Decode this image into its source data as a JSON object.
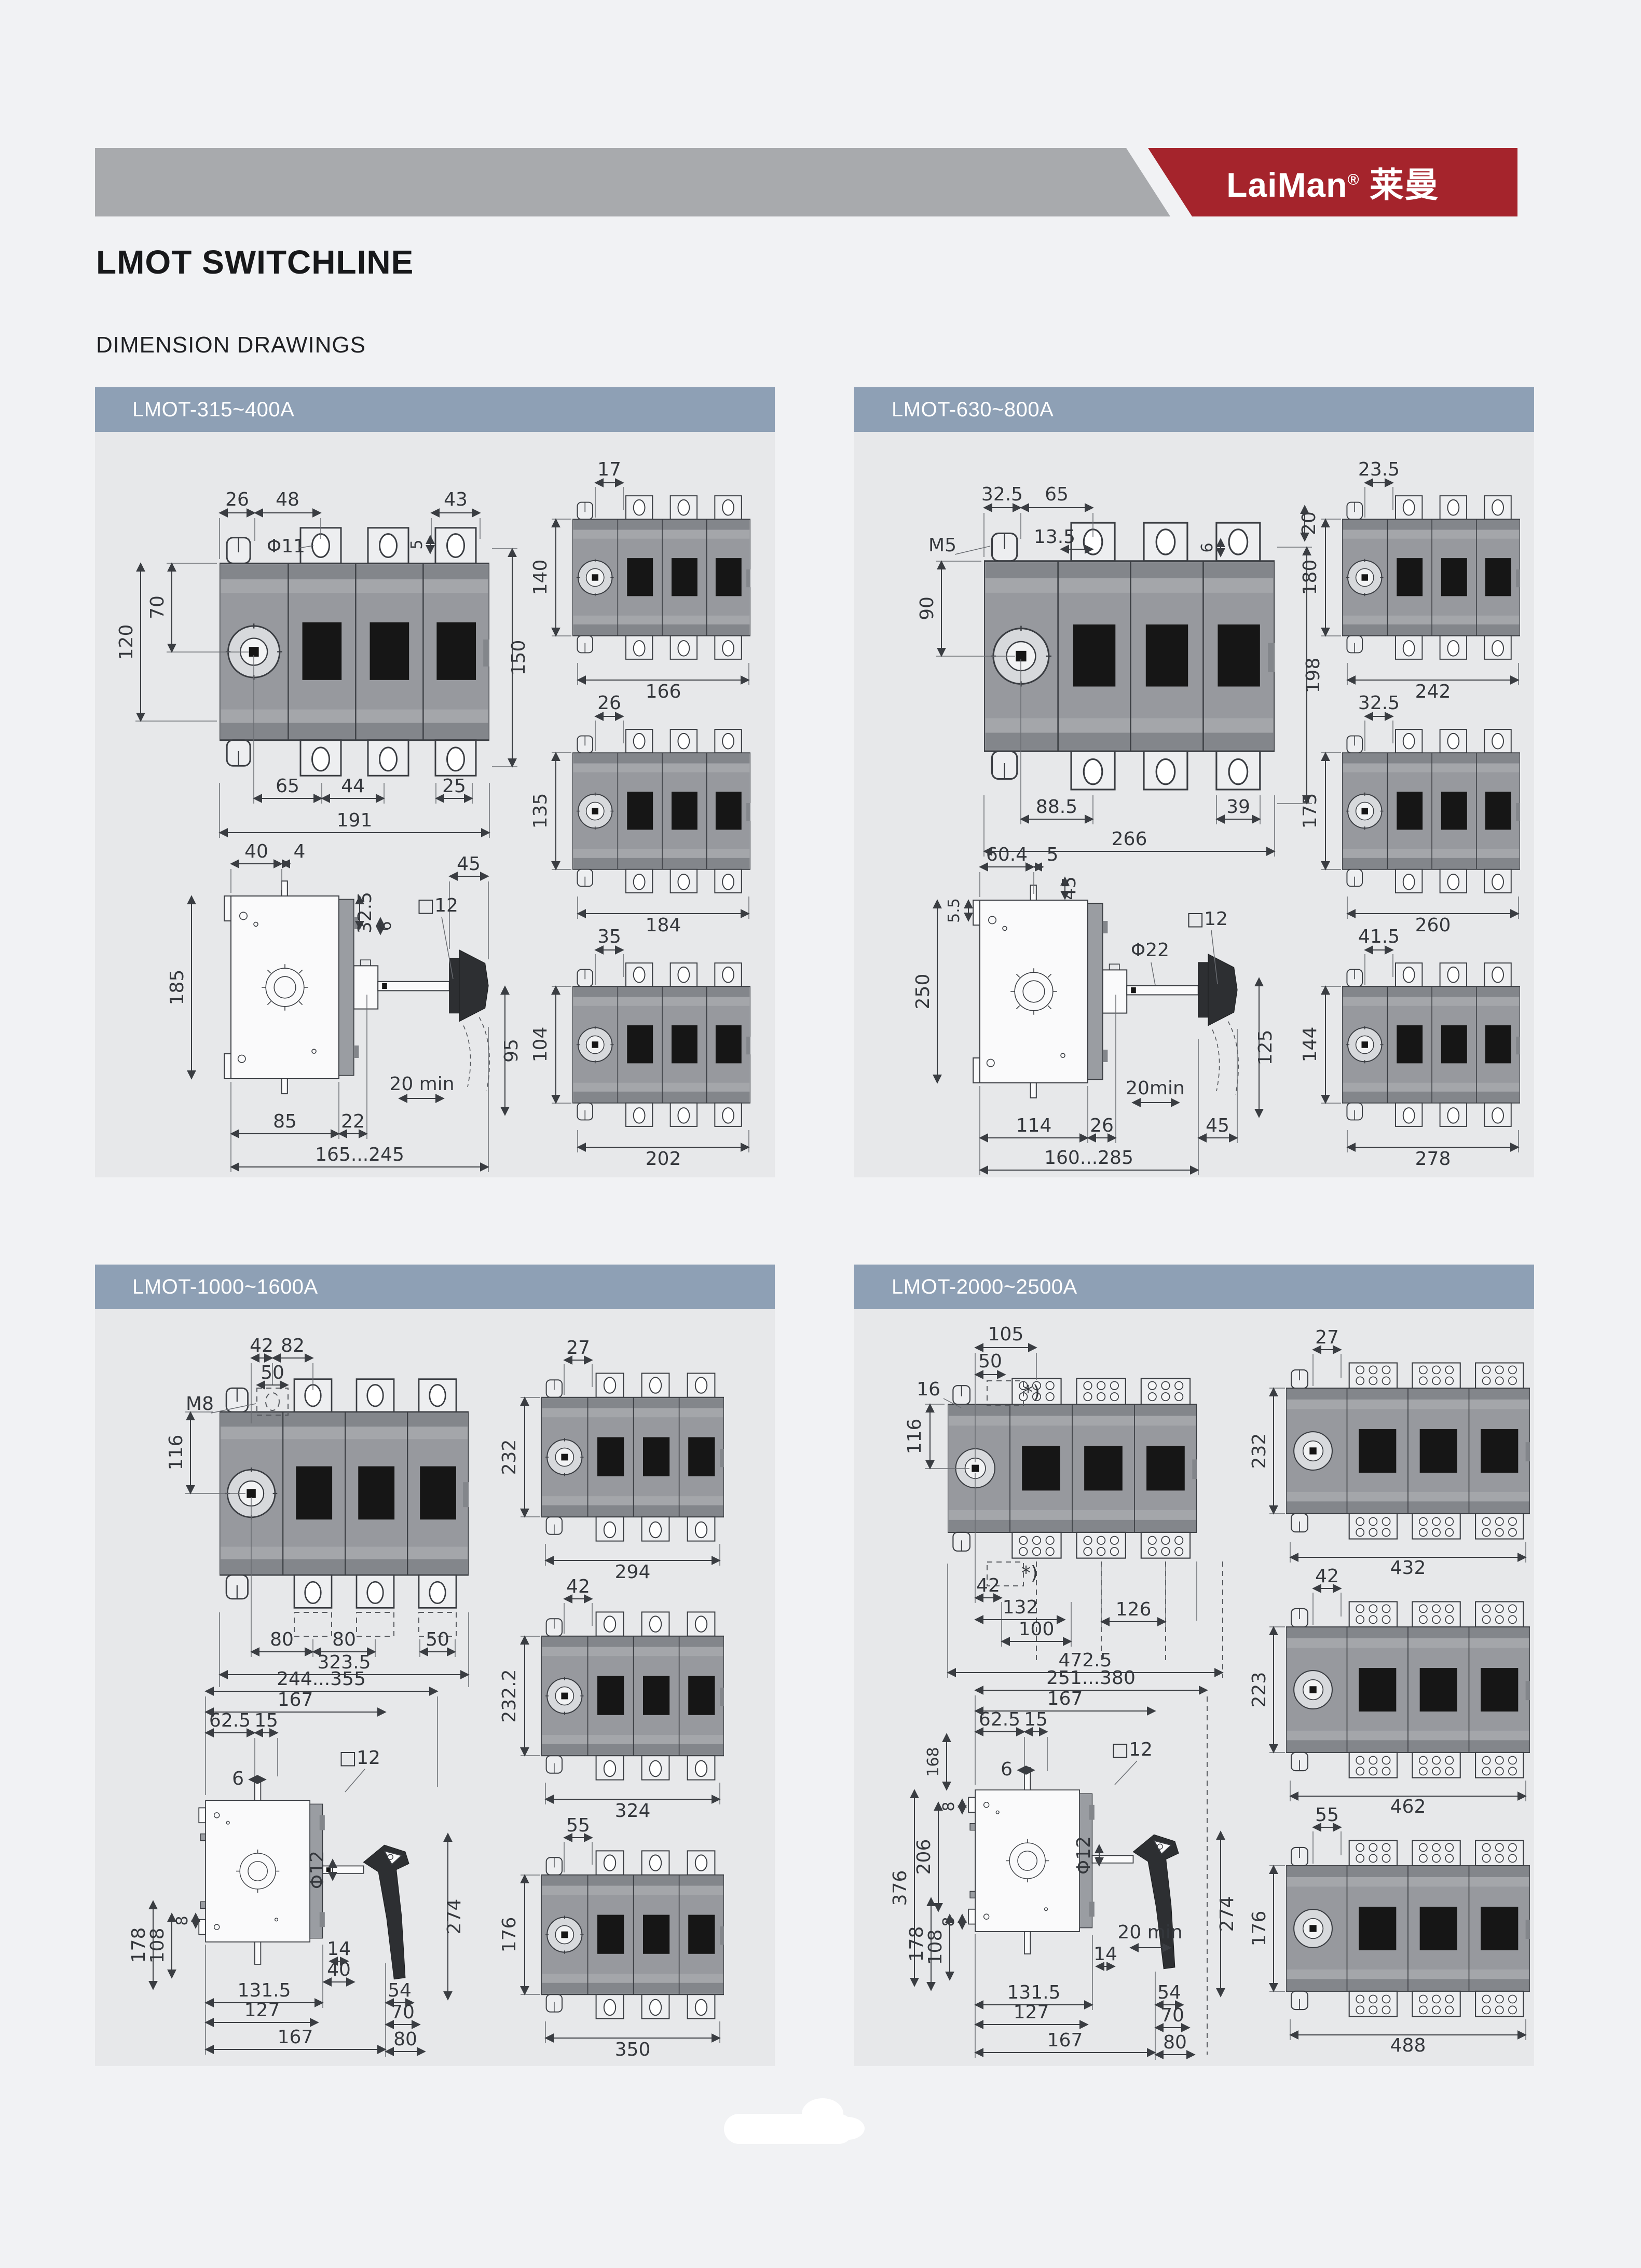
{
  "page": {
    "logo": {
      "text": "LaiMan",
      "reg": "®",
      "cn": "莱曼"
    },
    "title": "LMOT SWITCHLINE",
    "subtitle": "DIMENSION DRAWINGS",
    "colors": {
      "accent_red": "#a5242c",
      "top_bar_gray": "#a8aaad",
      "panel_header_blue": "#8ea0b5",
      "panel_bg": "#e7e8ea",
      "page_bg": "#f1f2f4"
    }
  },
  "panels": [
    {
      "title": "LMOT-315~400A",
      "front": [
        "26",
        "48",
        "43",
        "Φ11",
        "5",
        "70",
        "120",
        "150",
        "65",
        "44",
        "25",
        "191"
      ],
      "side": [
        "40",
        "4",
        "32.5",
        "6",
        "□12",
        "45",
        "185",
        "20 min",
        "95",
        "85",
        "22",
        "165...245"
      ],
      "rears": [
        [
          "17",
          "140",
          "166"
        ],
        [
          "26",
          "135",
          "184"
        ],
        [
          "35",
          "104",
          "202"
        ]
      ]
    },
    {
      "title": "LMOT-630~800A",
      "front": [
        "32.5",
        "65",
        "M5",
        "13.5",
        "6",
        "20",
        "90",
        "198",
        "88.5",
        "39",
        "266"
      ],
      "side": [
        "60.4",
        "5",
        "5.5",
        "45",
        "Φ22",
        "□12",
        "250",
        "20min",
        "114",
        "26",
        "45",
        "160...285",
        "125"
      ],
      "rears": [
        [
          "23.5",
          "180",
          "242"
        ],
        [
          "32.5",
          "175",
          "260"
        ],
        [
          "41.5",
          "144",
          "278"
        ]
      ]
    },
    {
      "title": "LMOT-1000~1600A",
      "front": [
        "42",
        "82",
        "50",
        "M8",
        "116",
        "80",
        "80",
        "50",
        "323.5"
      ],
      "side": [
        "244...355",
        "167",
        "62.5",
        "15",
        "6",
        "□12",
        "Φ12",
        "8",
        "178",
        "108",
        "14",
        "40",
        "131.5",
        "127",
        "167",
        "54",
        "70",
        "80",
        "274"
      ],
      "rears": [
        [
          "27",
          "232",
          "294"
        ],
        [
          "42",
          "232.2",
          "324"
        ],
        [
          "55",
          "176",
          "350"
        ]
      ]
    },
    {
      "title": "LMOT-2000~2500A",
      "front": [
        "105",
        "50",
        "16",
        "116",
        "42",
        "132",
        "100",
        "126",
        "472.5",
        "*)",
        "*)"
      ],
      "side": [
        "251...380",
        "167",
        "62.5",
        "15",
        "168",
        "6",
        "□12",
        "Φ12",
        "8",
        "206",
        "8",
        "376",
        "178",
        "108",
        "14",
        "131.5",
        "127",
        "167",
        "20 min",
        "54",
        "70",
        "80",
        "274"
      ],
      "rears": [
        [
          "27",
          "232",
          "432"
        ],
        [
          "42",
          "223",
          "462"
        ],
        [
          "55",
          "176",
          "488"
        ]
      ]
    }
  ]
}
